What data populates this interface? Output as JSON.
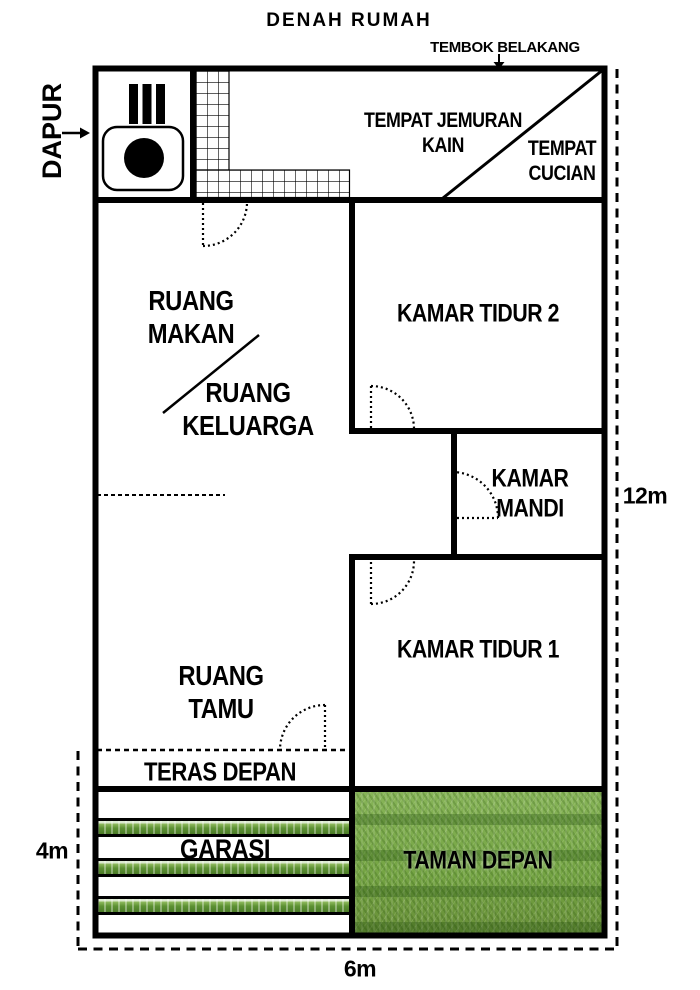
{
  "title": "DENAH RUMAH",
  "annotations": {
    "back_wall": "TEMBOK BELAKANG",
    "kitchen": "DAPUR"
  },
  "rooms": {
    "jemuran": {
      "line1": "TEMPAT JEMURAN",
      "line2": "KAIN"
    },
    "cucian": {
      "line1": "TEMPAT",
      "line2": "CUCIAN"
    },
    "makan": {
      "line1": "RUANG",
      "line2": "MAKAN"
    },
    "keluarga": {
      "line1": "RUANG",
      "line2": "KELUARGA"
    },
    "tidur2": "KAMAR TIDUR 2",
    "mandi": {
      "line1": "KAMAR",
      "line2": "MANDI"
    },
    "tidur1": "KAMAR TIDUR 1",
    "tamu": {
      "line1": "RUANG",
      "line2": "TAMU"
    },
    "teras": "TERAS DEPAN",
    "garasi": "GARASI",
    "taman": "TAMAN DEPAN"
  },
  "dimensions": {
    "plot_depth": "12m",
    "front_yard_depth": "4m",
    "plot_width": "6m"
  },
  "icons": {
    "stove": "stove-icon",
    "back_wall_pointer": "down-arrow-icon",
    "kitchen_pointer": "right-arrow-icon"
  },
  "colors": {
    "line": "#000000",
    "background": "#ffffff",
    "grass_light": "#8db95c",
    "grass_dark": "#4a7a26"
  }
}
